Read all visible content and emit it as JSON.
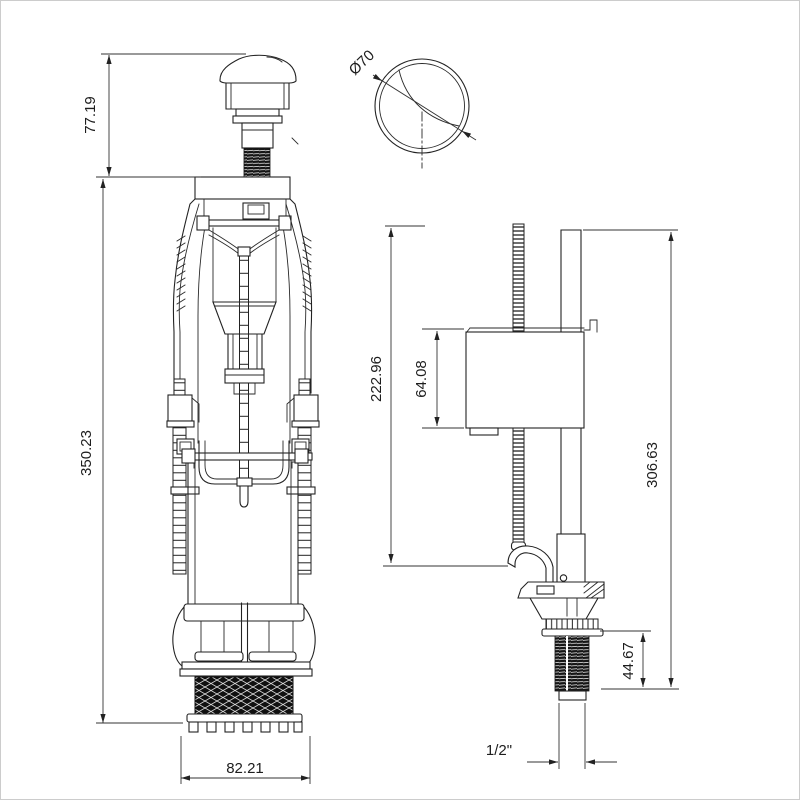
{
  "canvas": {
    "background": "#ffffff",
    "line_color": "#222222",
    "border_color": "#cccccc"
  },
  "views": {
    "flush_valve": {
      "label": "flush-valve-side-view",
      "dims": {
        "button_height": "77.19",
        "overall_height": "350.23",
        "base_width": "82.21"
      }
    },
    "push_button_top": {
      "label": "push-button-top-view",
      "dims": {
        "diameter": "Ø70"
      }
    },
    "fill_valve": {
      "label": "fill-valve-side-view",
      "dims": {
        "rod_height": "222.96",
        "float_height": "64.08",
        "overall_height": "306.63",
        "shank_length": "44.67",
        "thread_size": "1/2\""
      }
    }
  }
}
